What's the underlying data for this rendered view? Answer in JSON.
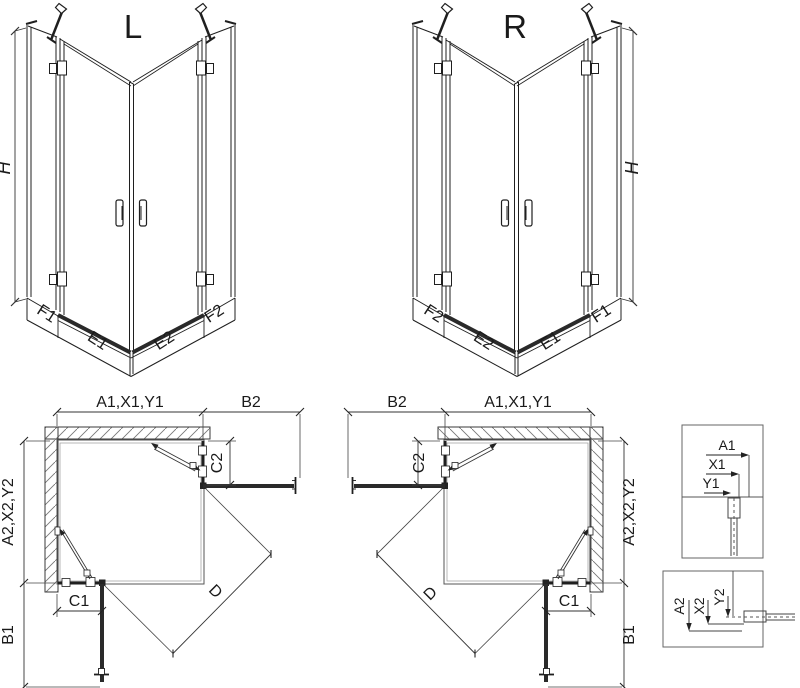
{
  "colors": {
    "line": "#1f1f1f",
    "dim": "#333333",
    "wall": "#3a3a3a",
    "panel_dark": "#2a2a2a"
  },
  "iso_left": {
    "title": "L",
    "height_label": "H",
    "labels": {
      "f1": "F1",
      "e1": "E1",
      "e2": "E2",
      "f2": "F2"
    }
  },
  "iso_right": {
    "title": "R",
    "height_label": "H",
    "labels": {
      "f2": "F2",
      "e2": "E2",
      "e1": "E1",
      "f1": "F1"
    }
  },
  "plan_left": {
    "width_label": "A1,X1,Y1",
    "return_label": "B2",
    "depth_label": "A2,X2,Y2",
    "fixed_side_label": "C2",
    "fixed_bottom_label": "C1",
    "front_label": "B1",
    "diagonal_label": "D"
  },
  "plan_right": {
    "width_label": "A1,X1,Y1",
    "return_label": "B2",
    "depth_label": "A2,X2,Y2",
    "fixed_side_label": "C2",
    "fixed_bottom_label": "C1",
    "front_label": "B1",
    "diagonal_label": "D"
  },
  "detail_top": {
    "a1": "A1",
    "x1": "X1",
    "y1": "Y1"
  },
  "detail_bottom": {
    "a2": "A2",
    "x2": "X2",
    "y2": "Y2"
  }
}
